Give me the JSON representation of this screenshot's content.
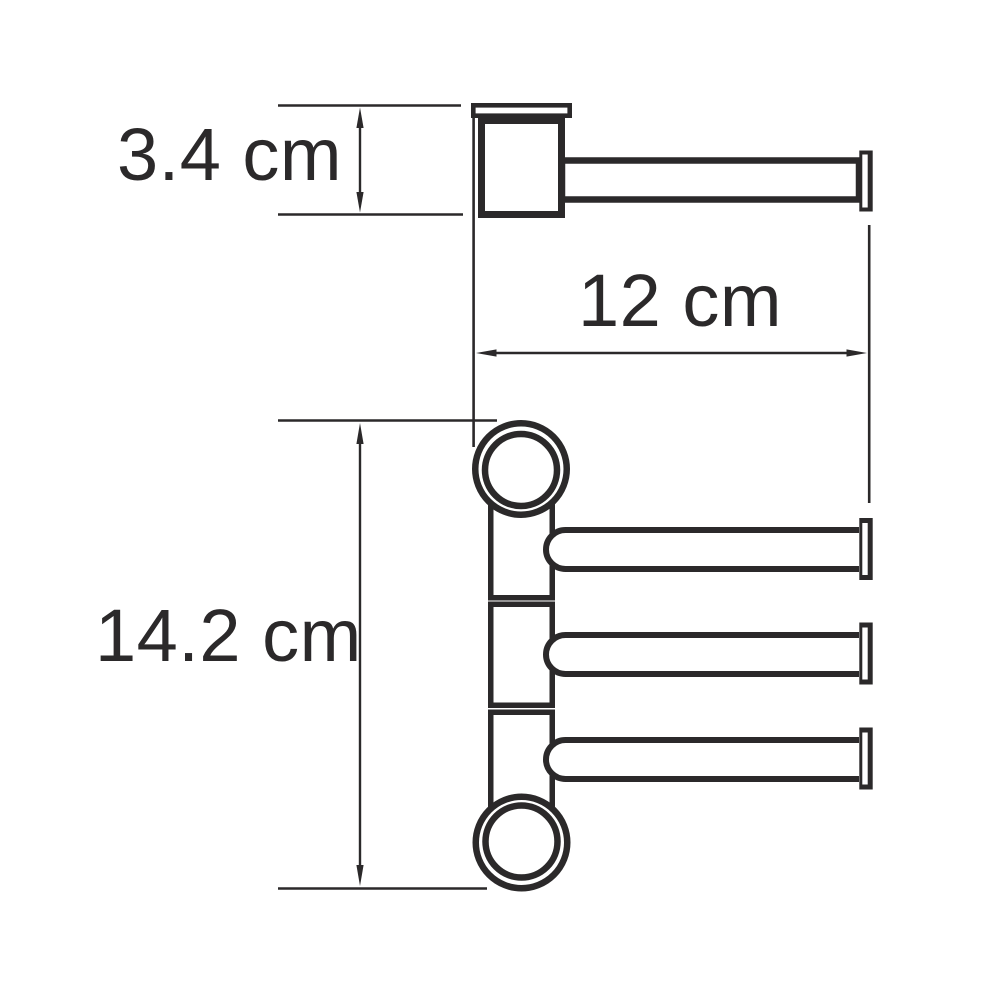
{
  "canvas": {
    "background": "#ffffff",
    "line_color": "#2b292a"
  },
  "diagram": {
    "type": "technical-dimension-drawing",
    "arm_count": 3,
    "dimensions": {
      "mount_height": "3.4 cm",
      "arm_length": "12 cm",
      "total_height": "14.2 cm"
    }
  }
}
